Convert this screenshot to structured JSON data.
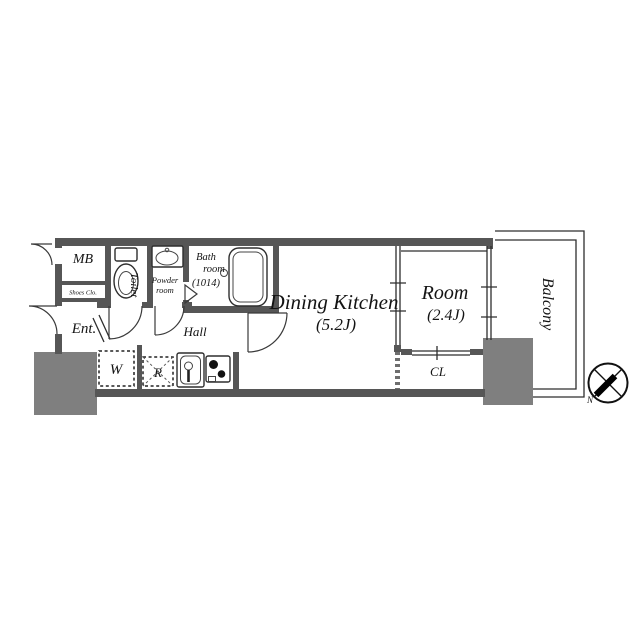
{
  "floor_plan": {
    "rooms": {
      "meter_box": "MB",
      "shoes_closet": "Shoes Clo.",
      "entrance": "Ent.",
      "toilet": "Toilet",
      "powder_line1": "Powder",
      "powder_line2": "room",
      "bath_line1": "Bath",
      "bath_line2": "room",
      "bath_line3": "(1014)",
      "hall": "Hall",
      "dining_kitchen": "Dining Kitchen",
      "dining_kitchen_area": "(5.2J)",
      "room": "Room",
      "room_area": "(2.4J)",
      "closet": "CL",
      "balcony": "Balcony",
      "washer": "W",
      "refrigerator": "R"
    },
    "compass": {
      "north": "N"
    },
    "colors": {
      "wall": "#565656",
      "pillar": "#7f7f7f",
      "line": "#2e2e2e"
    }
  }
}
